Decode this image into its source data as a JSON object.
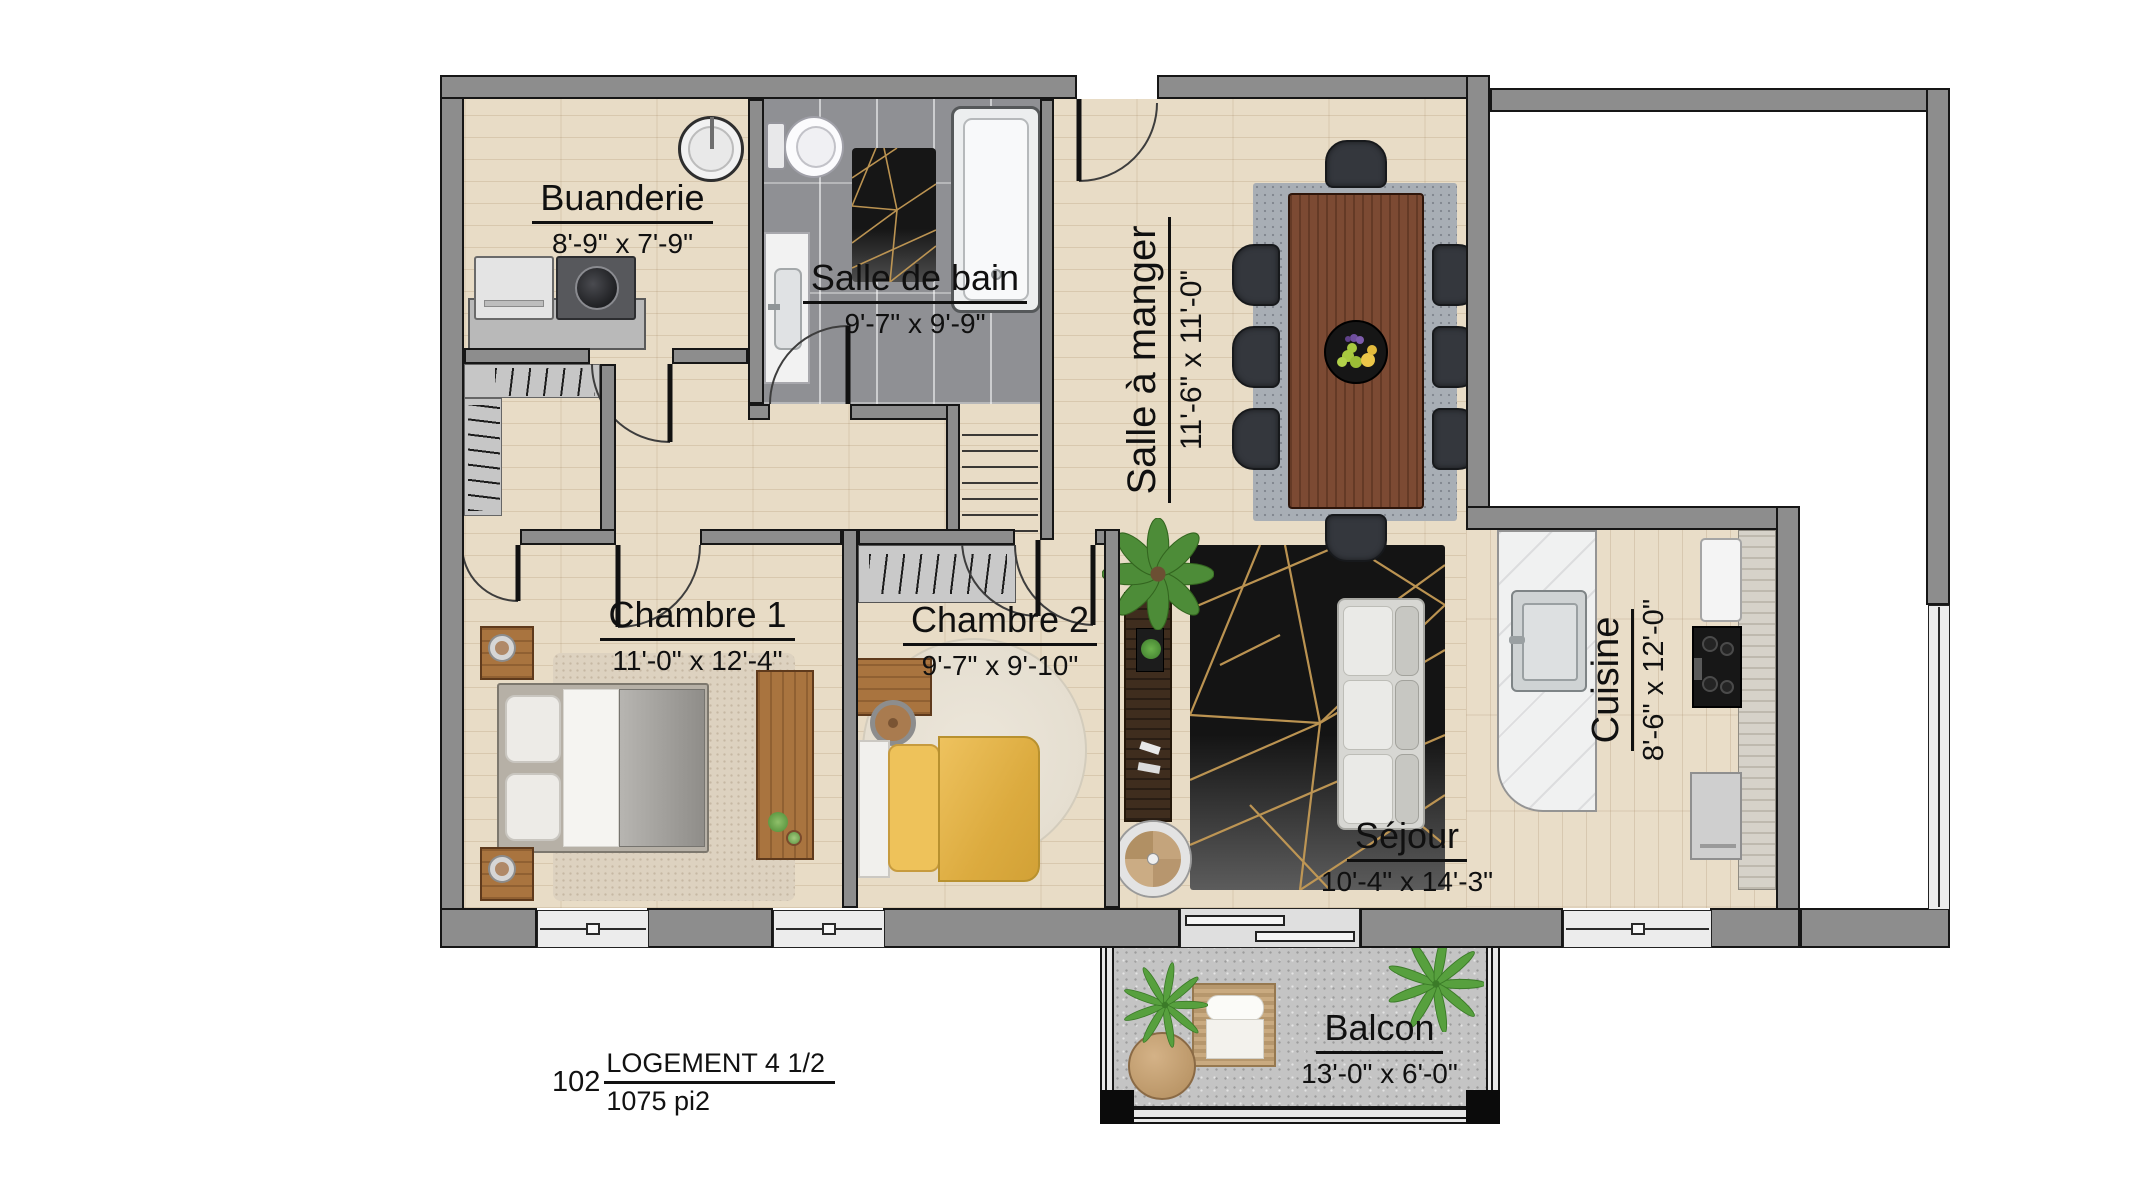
{
  "unit": {
    "number": "102",
    "type": "LOGEMENT 4 1/2",
    "area": "1075 pi2"
  },
  "rooms": {
    "buanderie": {
      "name": "Buanderie",
      "dims": "8'-9\" x 7'-9\""
    },
    "salle_de_bain": {
      "name": "Salle de bain",
      "dims": "9'-7\" x 9'-9\""
    },
    "salle_a_manger": {
      "name": "Salle à manger",
      "dims": "11'-6\" x 11'-0\""
    },
    "chambre1": {
      "name": "Chambre 1",
      "dims": "11'-0\" x 12'-4\""
    },
    "chambre2": {
      "name": "Chambre 2",
      "dims": "9'-7\" x 9'-10\""
    },
    "cuisine": {
      "name": "Cuisine",
      "dims": "8'-6\" x 12'-0\""
    },
    "sejour": {
      "name": "Séjour",
      "dims": "10'-4\" x 14'-3\""
    },
    "balcon": {
      "name": "Balcon",
      "dims": "13'-0\" x 6'-0\""
    }
  },
  "colors": {
    "wall": "#8d8d8d",
    "wall_outline": "#161616",
    "wood_floor": "#e8dcc6",
    "bath_tile": "#8f9094",
    "balcony_concrete": "#c4c4c4",
    "rug_black": "#141414",
    "rug_gold": "#c49a55",
    "bed_yellow": "#e3b44c",
    "dining_table_wood": "#7c4a33",
    "furniture_wood": "#a9743f"
  }
}
